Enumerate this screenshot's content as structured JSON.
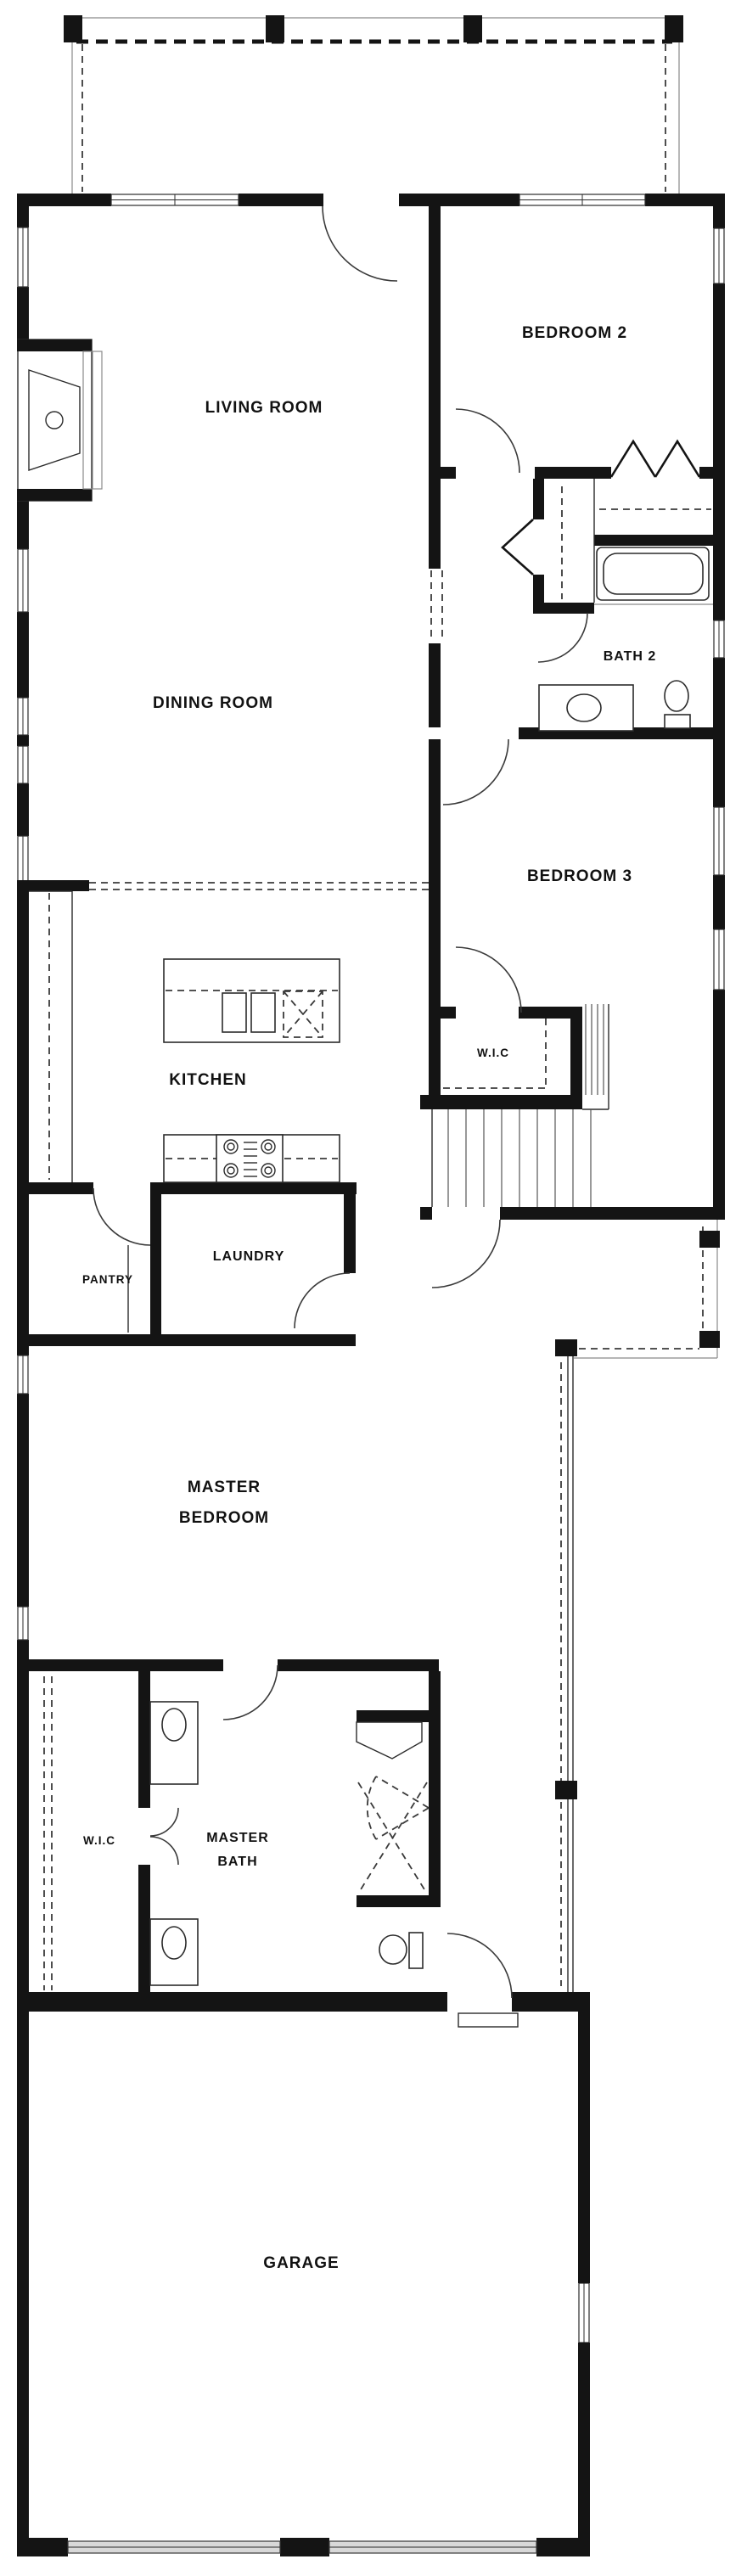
{
  "plan": {
    "type": "single-story house floor plan",
    "colors": {
      "wall": "#141414",
      "line": "#2b2b2b",
      "dash": "#3a3a3a",
      "garage_door": "#d8d8d8",
      "background": "#ffffff"
    },
    "rooms": {
      "living_room": {
        "label": "LIVING ROOM"
      },
      "bedroom2": {
        "label": "BEDROOM 2"
      },
      "dining_room": {
        "label": "DINING ROOM"
      },
      "bath2": {
        "label": "BATH 2"
      },
      "bedroom3": {
        "label": "BEDROOM 3"
      },
      "wic_bedroom3": {
        "label": "W.I.C"
      },
      "kitchen": {
        "label": "KITCHEN"
      },
      "pantry": {
        "label": "PANTRY"
      },
      "laundry": {
        "label": "LAUNDRY"
      },
      "master_bedroom": {
        "label_line1": "MASTER",
        "label_line2": "BEDROOM"
      },
      "wic_master": {
        "label": "W.I.C"
      },
      "master_bath": {
        "label_line1": "MASTER",
        "label_line2": "BATH"
      },
      "garage": {
        "label": "GARAGE"
      }
    }
  }
}
